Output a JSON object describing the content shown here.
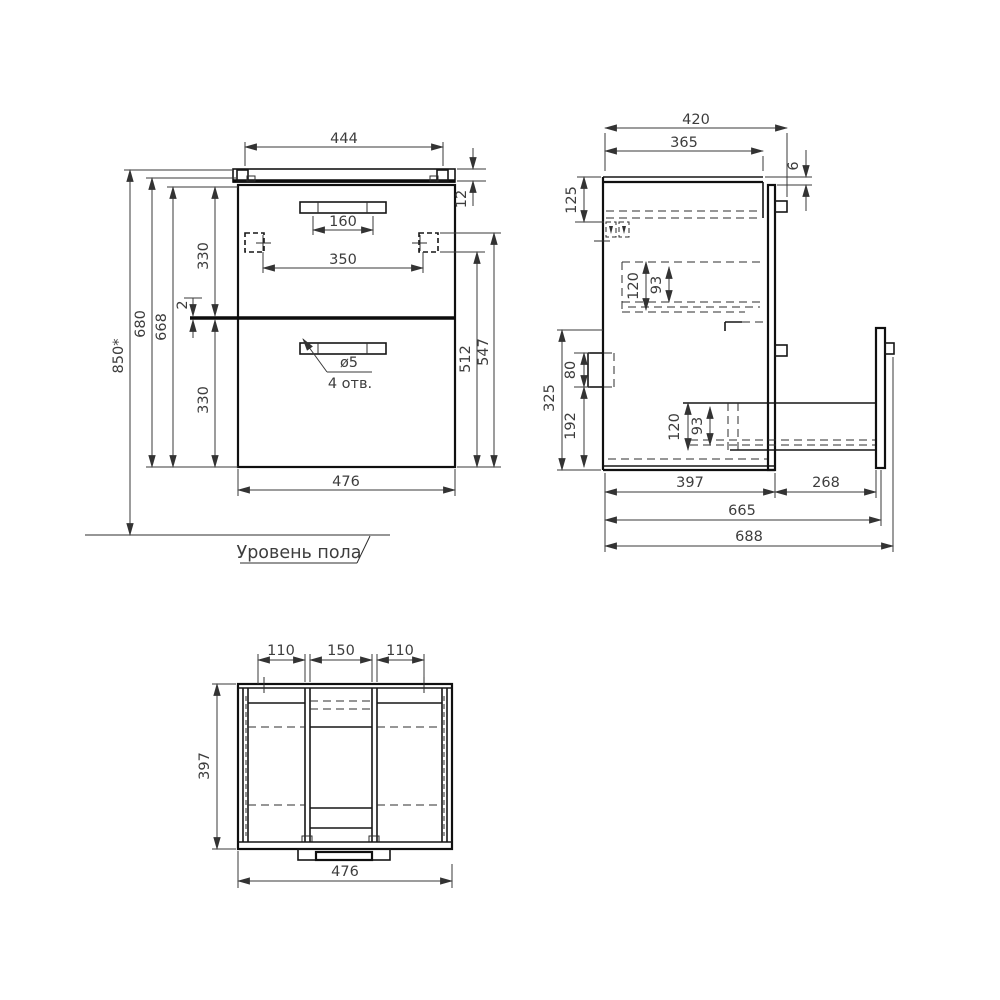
{
  "title": "Cabinet technical drawing",
  "floor_label": "Уровень пола",
  "callout": {
    "diameter": "ø5",
    "holes": "4 отв."
  },
  "front_view": {
    "top_width": "444",
    "handle_spacing": "160",
    "mount_spacing": "350",
    "overall_height": "850*",
    "height_680": "680",
    "height_668": "668",
    "upper_drawer": "330",
    "gap": "2",
    "lower_drawer": "330",
    "top_thickness": "12",
    "mount_512": "512",
    "mount_547": "547",
    "width": "476"
  },
  "side_view": {
    "overall_depth": "420",
    "top_depth": "365",
    "back_gap": "6",
    "mount_offset": "125",
    "upper_box_120": "120",
    "upper_box_93": "93",
    "lower_zone": "325",
    "bracket": "80",
    "bottom_zone": "192",
    "lower_box_120": "120",
    "lower_box_93": "93",
    "body_depth": "397",
    "drawer_extension": "268",
    "extended_665": "665",
    "extended_688": "688"
  },
  "top_view": {
    "left_bay": "110",
    "center_bay": "150",
    "right_bay": "110",
    "depth": "397",
    "width": "476"
  }
}
